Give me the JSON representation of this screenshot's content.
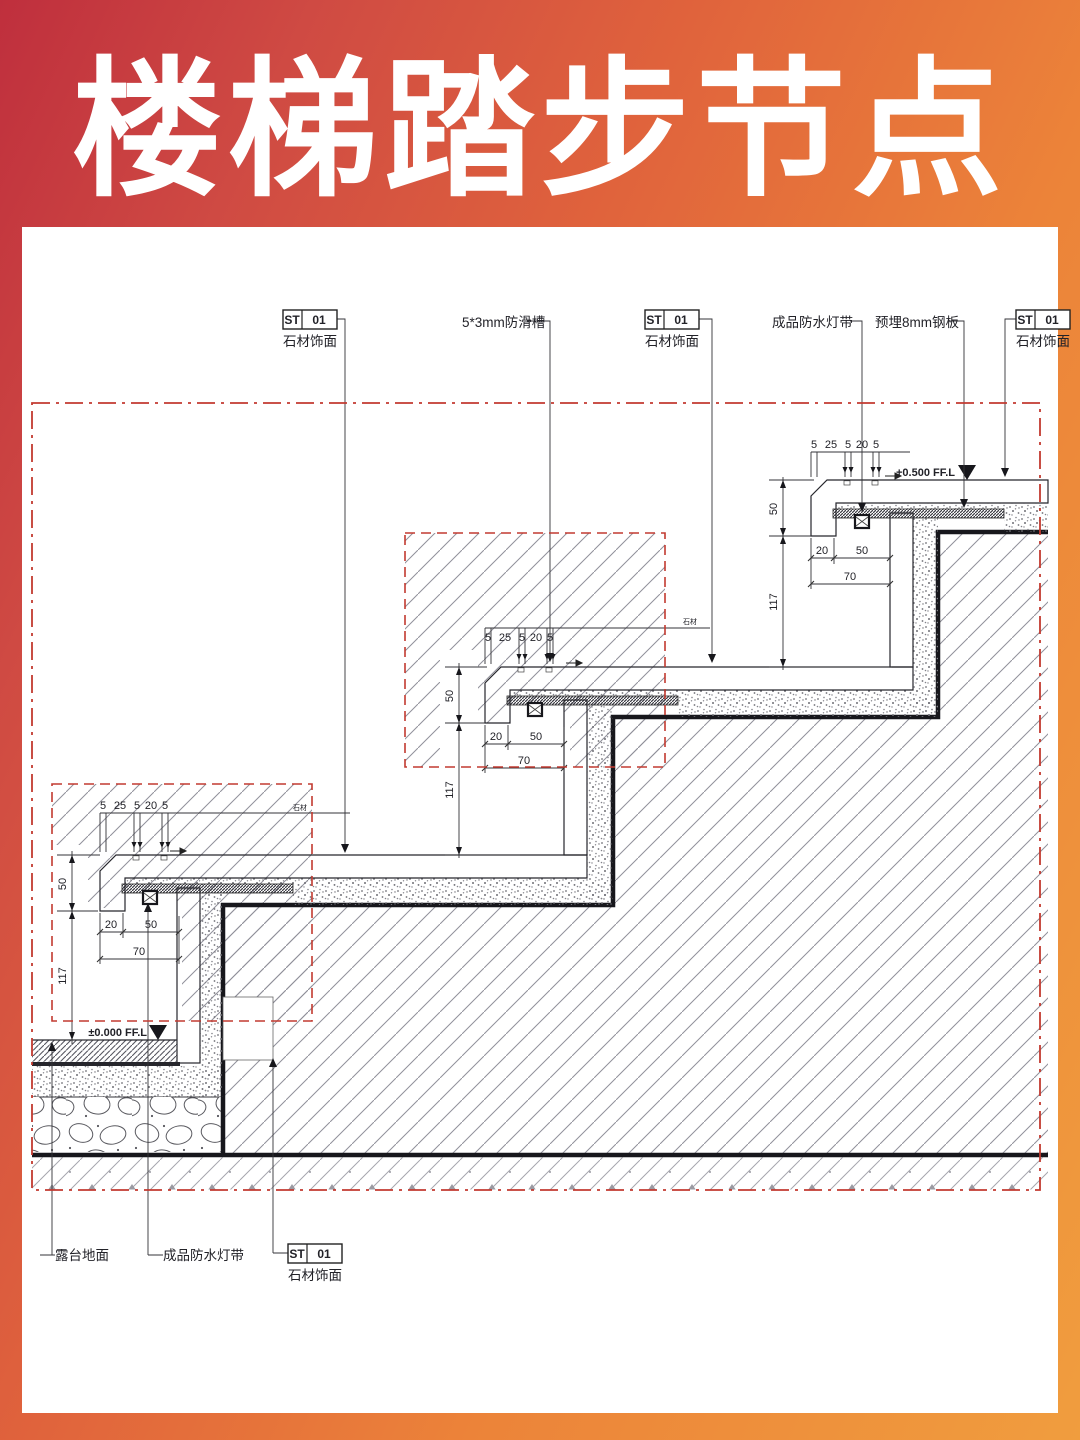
{
  "header": {
    "title": "楼梯踏步节点"
  },
  "tags": {
    "st": "ST",
    "num": "01",
    "name": "石材饰面"
  },
  "callouts": {
    "anti_slip": "5*3mm防滑槽",
    "light_strip": "成品防水灯带",
    "steel_plate": "预埋8mm钢板",
    "terrace_floor": "露台地面",
    "tiny_note": "石材"
  },
  "levels": {
    "upper": "+0.500 FF.L",
    "ground": "±0.000 FF.L"
  },
  "dims": {
    "d5": "5",
    "d25": "25",
    "d20": "20",
    "d50": "50",
    "d70": "70",
    "d117": "117"
  },
  "colors": {
    "accent_red": "#c23a30",
    "frame_red": "#bf2f3d",
    "frame_orange": "#f09d3e",
    "line_dark": "#17171c"
  }
}
